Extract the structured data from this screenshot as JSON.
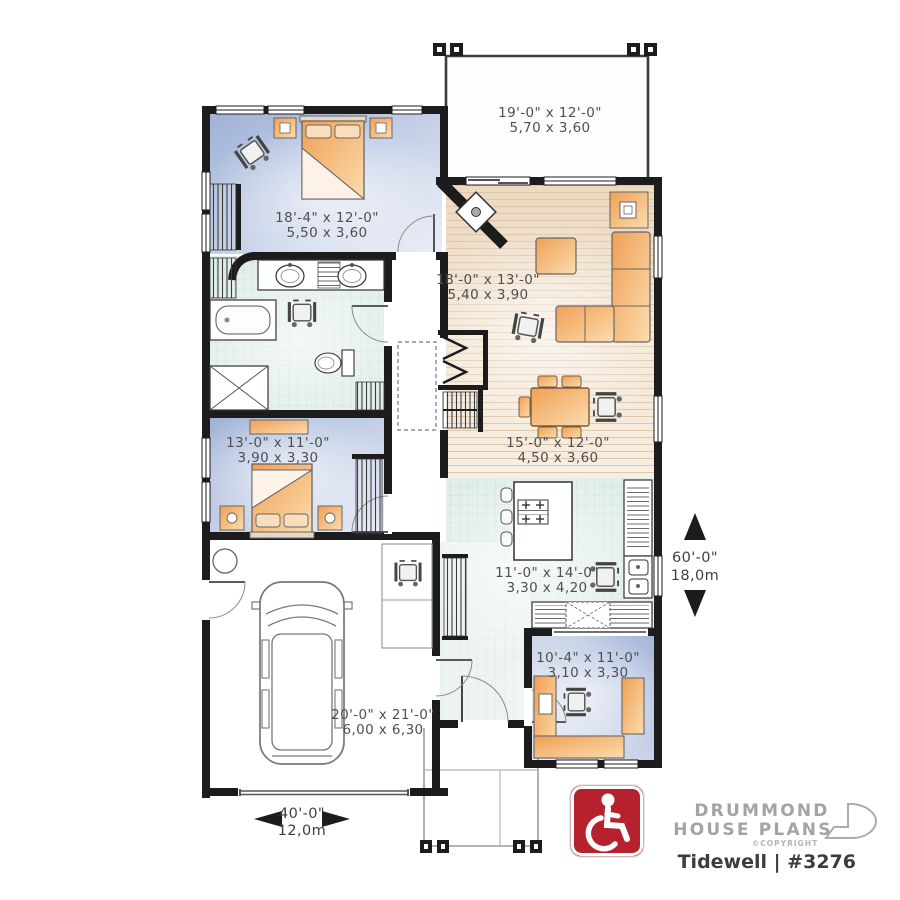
{
  "plan": {
    "type": "floor-plan",
    "accent_wall_color": "#1c1c1c"
  },
  "rooms": {
    "patio": {
      "dims_ft": "19'-0\" x 12'-0\"",
      "dims_m": "5,70 x 3,60"
    },
    "master_bedroom": {
      "dims_ft": "18'-4\" x 12'-0\"",
      "dims_m": "5,50 x 3,60"
    },
    "living_room": {
      "dims_ft": "18'-0\" x 13'-0\"",
      "dims_m": "5,40 x 3,90"
    },
    "dining_room": {
      "dims_ft": "15'-0\" x 12'-0\"",
      "dims_m": "4,50 x 3,60"
    },
    "bedroom_2": {
      "dims_ft": "13'-0\" x 11'-0\"",
      "dims_m": "3,90 x 3,30"
    },
    "kitchen": {
      "dims_ft": "11'-0\" x 14'-0\"",
      "dims_m": "3,30 x 4,20"
    },
    "office": {
      "dims_ft": "10'-4\" x 11'-0\"",
      "dims_m": "3,10 x 3,30"
    },
    "garage": {
      "dims_ft": "20'-0\" x 21'-0\"",
      "dims_m": "6,00 x 6,30"
    }
  },
  "dimensions": {
    "width_ft": "40'-0\"",
    "width_m": "12,0m",
    "depth_ft": "60'-0\"",
    "depth_m": "18,0m"
  },
  "branding": {
    "line1": "DRUMMOND",
    "line2": "HOUSE PLANS",
    "copyright": "©COPYRIGHT",
    "plan_name": "Tidewell | #3276",
    "logo_icon": "drummond-d-logo"
  },
  "accessibility": {
    "icon": "wheelchair-accessible-icon",
    "badge_color": "#b5222d",
    "wheelchair_count": 7
  },
  "colors": {
    "wall": "#1c1c1c",
    "bedroom_floor": "#a9b9da",
    "wood_floor": "#f1e2cf",
    "tile_floor": "#e2efe8",
    "furniture": "#f3a963",
    "badge_red": "#b5222d"
  }
}
